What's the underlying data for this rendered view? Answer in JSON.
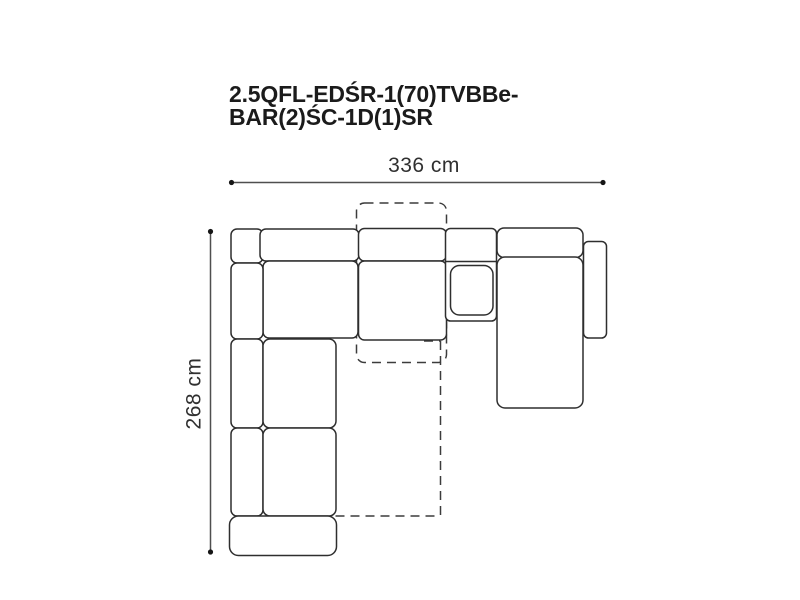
{
  "title": {
    "line1": "2.5QFL-EDŚR-1(70)TVBBe-",
    "line2": "BAR(2)ŚC-1D(1)SR"
  },
  "dimensions": {
    "width": "336 cm",
    "height": "268 cm"
  },
  "diagram": {
    "type": "corner-sofa-top-view",
    "modules": [
      "corner-backrest",
      "top-backrest-left",
      "top-backrest-middle",
      "top-seat-left",
      "top-seat-middle",
      "left-backrest-1",
      "left-backrest-2",
      "left-backrest-3",
      "left-seat-1",
      "left-seat-2",
      "front-ottoman",
      "bar-module",
      "bar-tray",
      "chaise-backrest",
      "chaise-longue",
      "right-armrest"
    ],
    "dashed_outlines": [
      "pullout-position-outline",
      "bed-extension-outline"
    ]
  },
  "colors": {
    "background": "#ffffff",
    "module_outline": "#2e2e2e",
    "dashed_outline": "#3c3c3c",
    "dimension_line": "#4f4f4f",
    "dimension_dot": "#161616",
    "title_text": "#1b1b1b",
    "dimension_text": "#303030"
  }
}
